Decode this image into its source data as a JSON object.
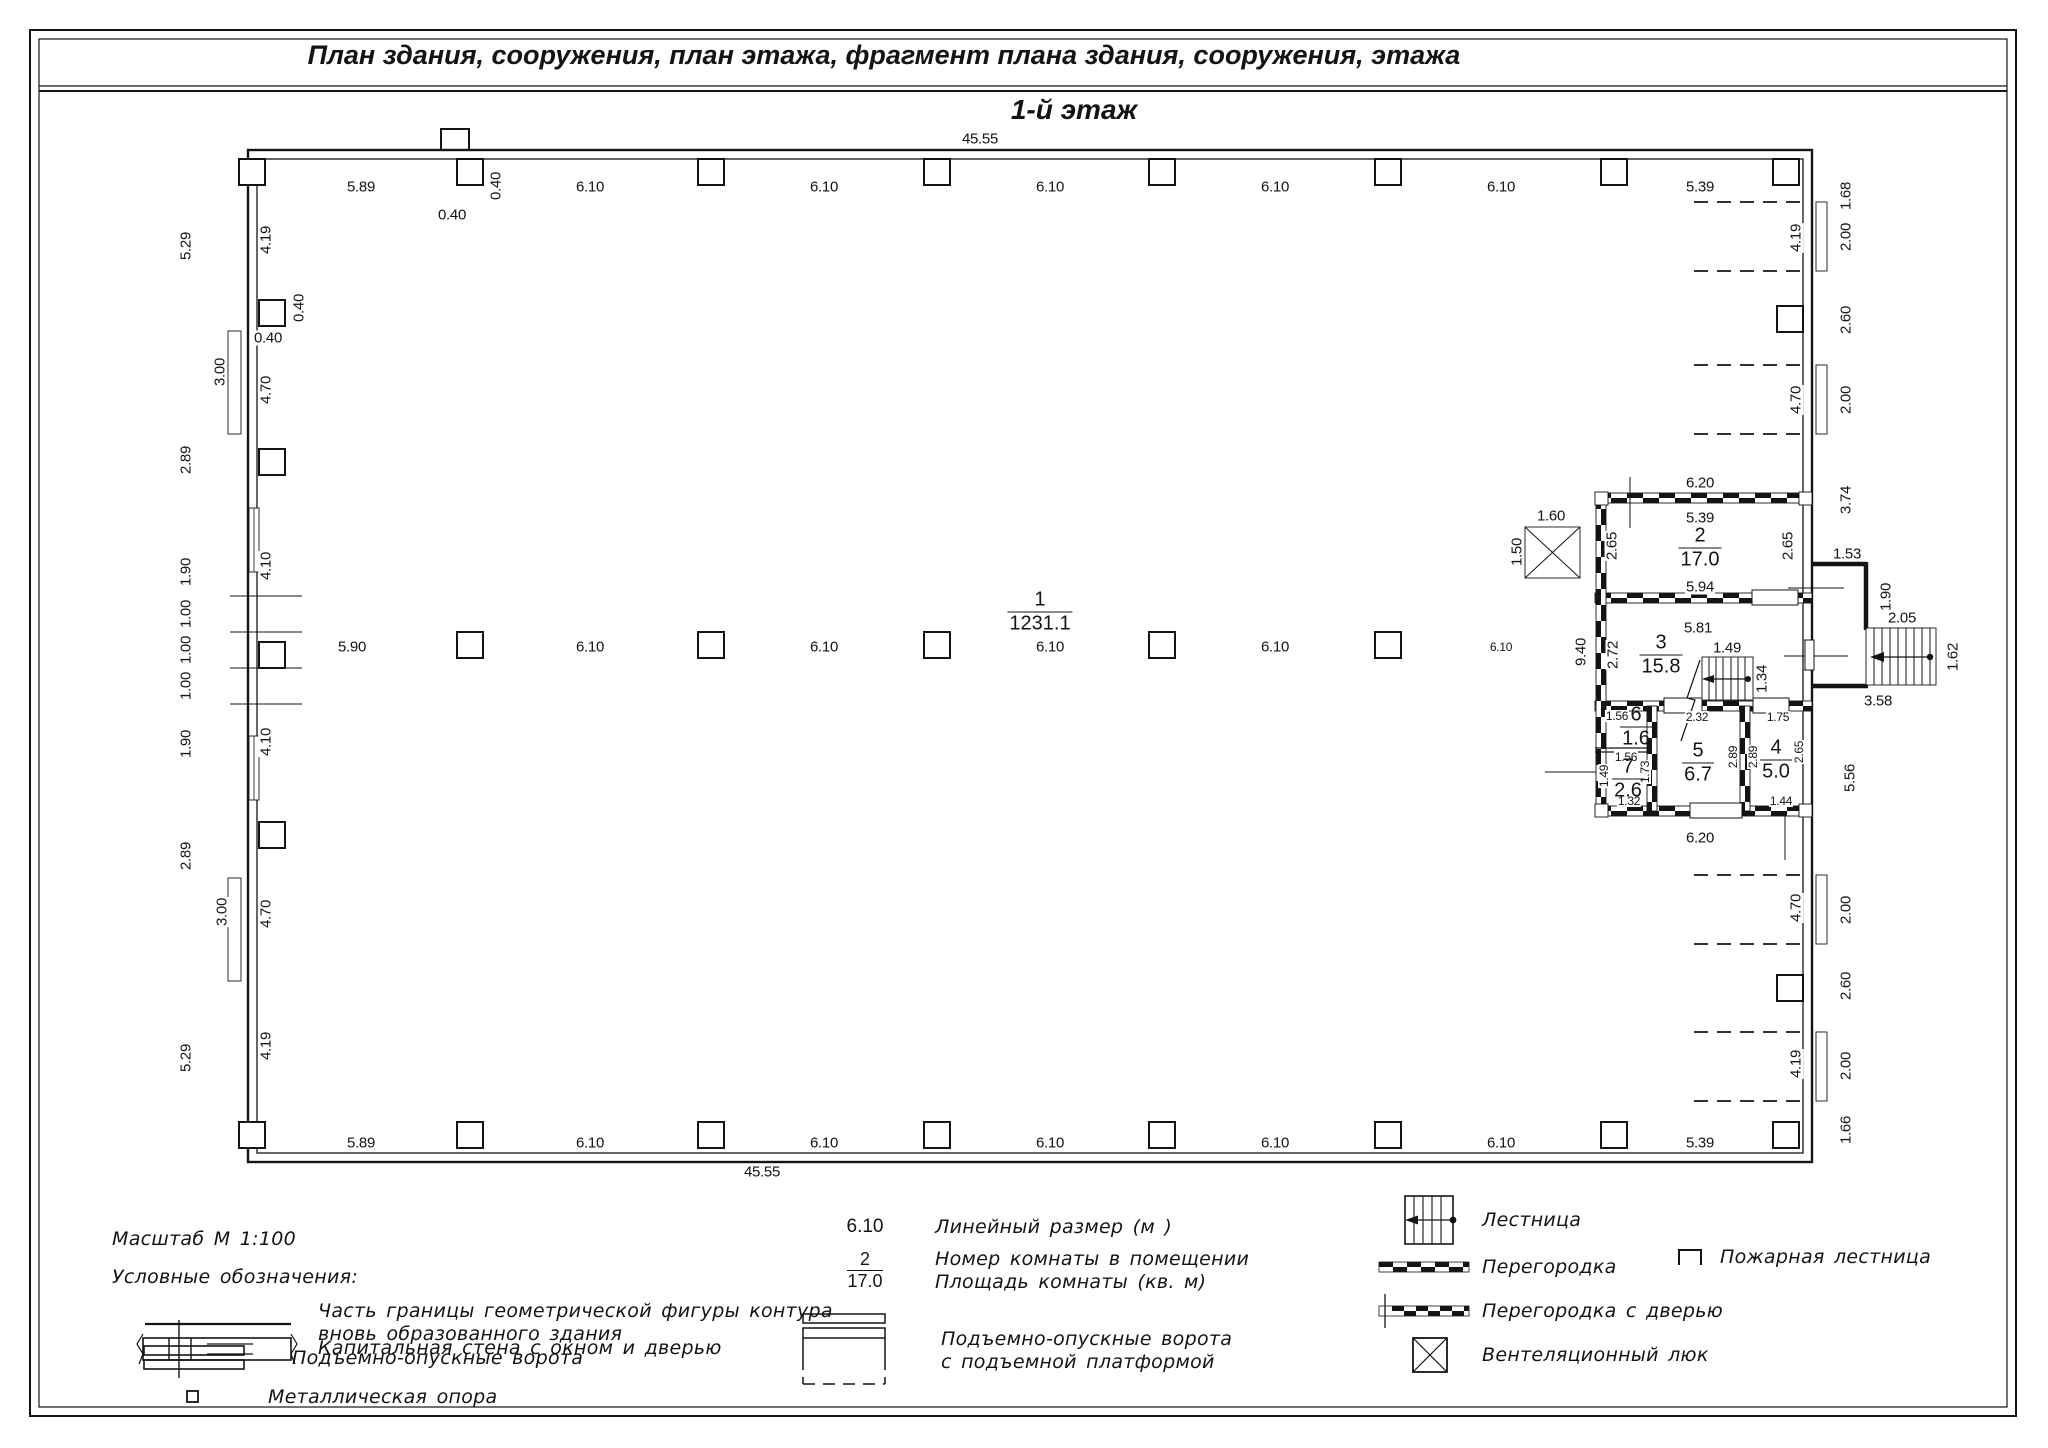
{
  "header": {
    "title": "План здания, сооружения, план этажа, фрагмент плана здания, сооружения, этажа",
    "floor": "1-й этаж"
  },
  "legend": {
    "scale": "Масштаб  М 1:100",
    "heading": "Условные обозначения:",
    "boundary_label_1": "Часть границы геометрической фигуры контура",
    "boundary_label_2": "вновь образованного здания",
    "capital_wall": "Капитальная стена с окном и дверью",
    "gates": "Подъемно-опускные ворота",
    "support": "Металлическая опора",
    "dim_symbol": "6.10",
    "dim_label": "Линейный размер (м )",
    "room_num_symbol": "2",
    "room_area_symbol": "17.0",
    "room_num_label": "Номер комнаты в помещении",
    "room_area_label": "Площадь комнаты (кв. м)",
    "platform_gates_1": "Подъемно-опускные ворота",
    "platform_gates_2": "с подъемной платформой",
    "stairs": "Лестница",
    "partition": "Перегородка",
    "partition_door": "Перегородка с дверью",
    "vent": "Вентеляционный люк",
    "fire_escape": "Пожарная лестница"
  },
  "plan": {
    "rooms": [
      {
        "num": "1",
        "area": "1231.1",
        "x": 1040,
        "y": 612
      },
      {
        "num": "2",
        "area": "17.0",
        "x": 1700,
        "y": 548
      },
      {
        "num": "3",
        "area": "15.8",
        "x": 1661,
        "y": 655
      },
      {
        "num": "4",
        "area": "5.0",
        "x": 1776,
        "y": 760
      },
      {
        "num": "5",
        "area": "6.7",
        "x": 1698,
        "y": 763
      },
      {
        "num": "6",
        "area": "1.6",
        "x": 1636,
        "y": 727
      },
      {
        "num": "7",
        "area": "2.6",
        "x": 1628,
        "y": 779
      }
    ],
    "columns": [
      [
        252,
        172
      ],
      [
        470,
        172
      ],
      [
        711,
        172
      ],
      [
        937,
        172
      ],
      [
        1162,
        172
      ],
      [
        1388,
        172
      ],
      [
        1614,
        172
      ],
      [
        1786,
        172
      ],
      [
        470,
        645
      ],
      [
        711,
        645
      ],
      [
        937,
        645
      ],
      [
        1162,
        645
      ],
      [
        1388,
        645
      ],
      [
        252,
        1135
      ],
      [
        470,
        1135
      ],
      [
        711,
        1135
      ],
      [
        937,
        1135
      ],
      [
        1162,
        1135
      ],
      [
        1388,
        1135
      ],
      [
        1614,
        1135
      ],
      [
        1786,
        1135
      ],
      [
        272,
        313
      ],
      [
        272,
        462
      ],
      [
        272,
        655
      ],
      [
        272,
        835
      ],
      [
        1790,
        319
      ],
      [
        1790,
        988
      ]
    ],
    "dim_labels": [
      {
        "t": "45.55",
        "x": 980,
        "y": 139
      },
      {
        "t": "5.89",
        "x": 361,
        "y": 187
      },
      {
        "t": "0.40",
        "x": 452,
        "y": 215
      },
      {
        "t": "0.40",
        "x": 496,
        "y": 186,
        "r": 1
      },
      {
        "t": "6.10",
        "x": 590,
        "y": 187
      },
      {
        "t": "6.10",
        "x": 824,
        "y": 187
      },
      {
        "t": "6.10",
        "x": 1050,
        "y": 187
      },
      {
        "t": "6.10",
        "x": 1275,
        "y": 187
      },
      {
        "t": "6.10",
        "x": 1501,
        "y": 187
      },
      {
        "t": "5.39",
        "x": 1700,
        "y": 187
      },
      {
        "t": "5.90",
        "x": 352,
        "y": 647
      },
      {
        "t": "6.10",
        "x": 590,
        "y": 647
      },
      {
        "t": "6.10",
        "x": 824,
        "y": 647
      },
      {
        "t": "6.10",
        "x": 1050,
        "y": 647
      },
      {
        "t": "6.10",
        "x": 1275,
        "y": 647
      },
      {
        "t": "6.10",
        "x": 1501,
        "y": 647,
        "s": 1
      },
      {
        "t": "5.89",
        "x": 361,
        "y": 1143
      },
      {
        "t": "6.10",
        "x": 590,
        "y": 1143
      },
      {
        "t": "6.10",
        "x": 824,
        "y": 1143
      },
      {
        "t": "6.10",
        "x": 1050,
        "y": 1143
      },
      {
        "t": "6.10",
        "x": 1275,
        "y": 1143
      },
      {
        "t": "6.10",
        "x": 1501,
        "y": 1143
      },
      {
        "t": "5.39",
        "x": 1700,
        "y": 1143
      },
      {
        "t": "45.55",
        "x": 762,
        "y": 1172
      },
      {
        "t": "5.29",
        "x": 186,
        "y": 246,
        "r": 1
      },
      {
        "t": "2.89",
        "x": 186,
        "y": 460,
        "r": 1
      },
      {
        "t": "1.90",
        "x": 186,
        "y": 572,
        "r": 1
      },
      {
        "t": "1.00",
        "x": 186,
        "y": 614,
        "r": 1
      },
      {
        "t": "1.00",
        "x": 186,
        "y": 650,
        "r": 1
      },
      {
        "t": "1.00",
        "x": 186,
        "y": 686,
        "r": 1
      },
      {
        "t": "1.90",
        "x": 186,
        "y": 744,
        "r": 1
      },
      {
        "t": "2.89",
        "x": 186,
        "y": 856,
        "r": 1
      },
      {
        "t": "5.29",
        "x": 186,
        "y": 1058,
        "r": 1
      },
      {
        "t": "3.00",
        "x": 220,
        "y": 372,
        "r": 1
      },
      {
        "t": "3.00",
        "x": 222,
        "y": 912,
        "r": 1
      },
      {
        "t": "0.40",
        "x": 268,
        "y": 338
      },
      {
        "t": "0.40",
        "x": 299,
        "y": 308,
        "r": 1
      },
      {
        "t": "4.19",
        "x": 266,
        "y": 240,
        "r": 1
      },
      {
        "t": "4.70",
        "x": 266,
        "y": 390,
        "r": 1
      },
      {
        "t": "4.10",
        "x": 266,
        "y": 566,
        "r": 1
      },
      {
        "t": "4.10",
        "x": 266,
        "y": 742,
        "r": 1
      },
      {
        "t": "4.70",
        "x": 266,
        "y": 914,
        "r": 1
      },
      {
        "t": "4.19",
        "x": 266,
        "y": 1046,
        "r": 1
      },
      {
        "t": "1.68",
        "x": 1846,
        "y": 196,
        "r": 1
      },
      {
        "t": "2.00",
        "x": 1846,
        "y": 237,
        "r": 1
      },
      {
        "t": "2.60",
        "x": 1846,
        "y": 320,
        "r": 1
      },
      {
        "t": "2.00",
        "x": 1846,
        "y": 400,
        "r": 1
      },
      {
        "t": "3.74",
        "x": 1846,
        "y": 500,
        "r": 1
      },
      {
        "t": "5.56",
        "x": 1850,
        "y": 778,
        "r": 1
      },
      {
        "t": "2.00",
        "x": 1846,
        "y": 910,
        "r": 1
      },
      {
        "t": "2.60",
        "x": 1846,
        "y": 986,
        "r": 1
      },
      {
        "t": "2.00",
        "x": 1846,
        "y": 1066,
        "r": 1
      },
      {
        "t": "1.66",
        "x": 1846,
        "y": 1130,
        "r": 1
      },
      {
        "t": "4.19",
        "x": 1796,
        "y": 238,
        "r": 1
      },
      {
        "t": "4.70",
        "x": 1796,
        "y": 400,
        "r": 1
      },
      {
        "t": "4.70",
        "x": 1796,
        "y": 908,
        "r": 1
      },
      {
        "t": "4.19",
        "x": 1796,
        "y": 1064,
        "r": 1
      },
      {
        "t": "1.53",
        "x": 1847,
        "y": 554
      },
      {
        "t": "1.90",
        "x": 1886,
        "y": 597,
        "r": 1
      },
      {
        "t": "2.05",
        "x": 1902,
        "y": 618
      },
      {
        "t": "1.62",
        "x": 1953,
        "y": 657,
        "r": 1
      },
      {
        "t": "3.58",
        "x": 1878,
        "y": 701
      },
      {
        "t": "6.20",
        "x": 1700,
        "y": 483
      },
      {
        "t": "5.39",
        "x": 1700,
        "y": 518
      },
      {
        "t": "2.65",
        "x": 1612,
        "y": 546,
        "r": 1
      },
      {
        "t": "2.65",
        "x": 1788,
        "y": 546,
        "r": 1
      },
      {
        "t": "5.94",
        "x": 1700,
        "y": 587
      },
      {
        "t": "5.81",
        "x": 1698,
        "y": 628
      },
      {
        "t": "2.72",
        "x": 1613,
        "y": 655,
        "r": 1
      },
      {
        "t": "9.40",
        "x": 1581,
        "y": 652,
        "r": 1
      },
      {
        "t": "1.49",
        "x": 1727,
        "y": 648
      },
      {
        "t": "1.34",
        "x": 1762,
        "y": 679,
        "r": 1
      },
      {
        "t": "1.56",
        "x": 1617,
        "y": 716,
        "s": 1
      },
      {
        "t": "2.32",
        "x": 1697,
        "y": 717,
        "s": 1
      },
      {
        "t": "1.75",
        "x": 1778,
        "y": 717,
        "s": 1
      },
      {
        "t": "2.89",
        "x": 1733,
        "y": 757,
        "r": 1,
        "s": 1
      },
      {
        "t": "2.89",
        "x": 1753,
        "y": 757,
        "r": 1,
        "s": 1
      },
      {
        "t": "2.65",
        "x": 1799,
        "y": 752,
        "r": 1,
        "s": 1
      },
      {
        "t": "1.56",
        "x": 1626,
        "y": 757,
        "s": 1
      },
      {
        "t": "1.49",
        "x": 1604,
        "y": 776,
        "r": 1,
        "s": 1
      },
      {
        "t": "1.73",
        "x": 1645,
        "y": 772,
        "r": 1,
        "s": 1
      },
      {
        "t": "1.32",
        "x": 1629,
        "y": 801,
        "s": 1
      },
      {
        "t": "1.44",
        "x": 1781,
        "y": 801,
        "s": 1
      },
      {
        "t": "6.20",
        "x": 1700,
        "y": 838
      },
      {
        "t": "1.60",
        "x": 1551,
        "y": 516
      },
      {
        "t": "1.50",
        "x": 1517,
        "y": 552,
        "r": 1
      }
    ]
  }
}
